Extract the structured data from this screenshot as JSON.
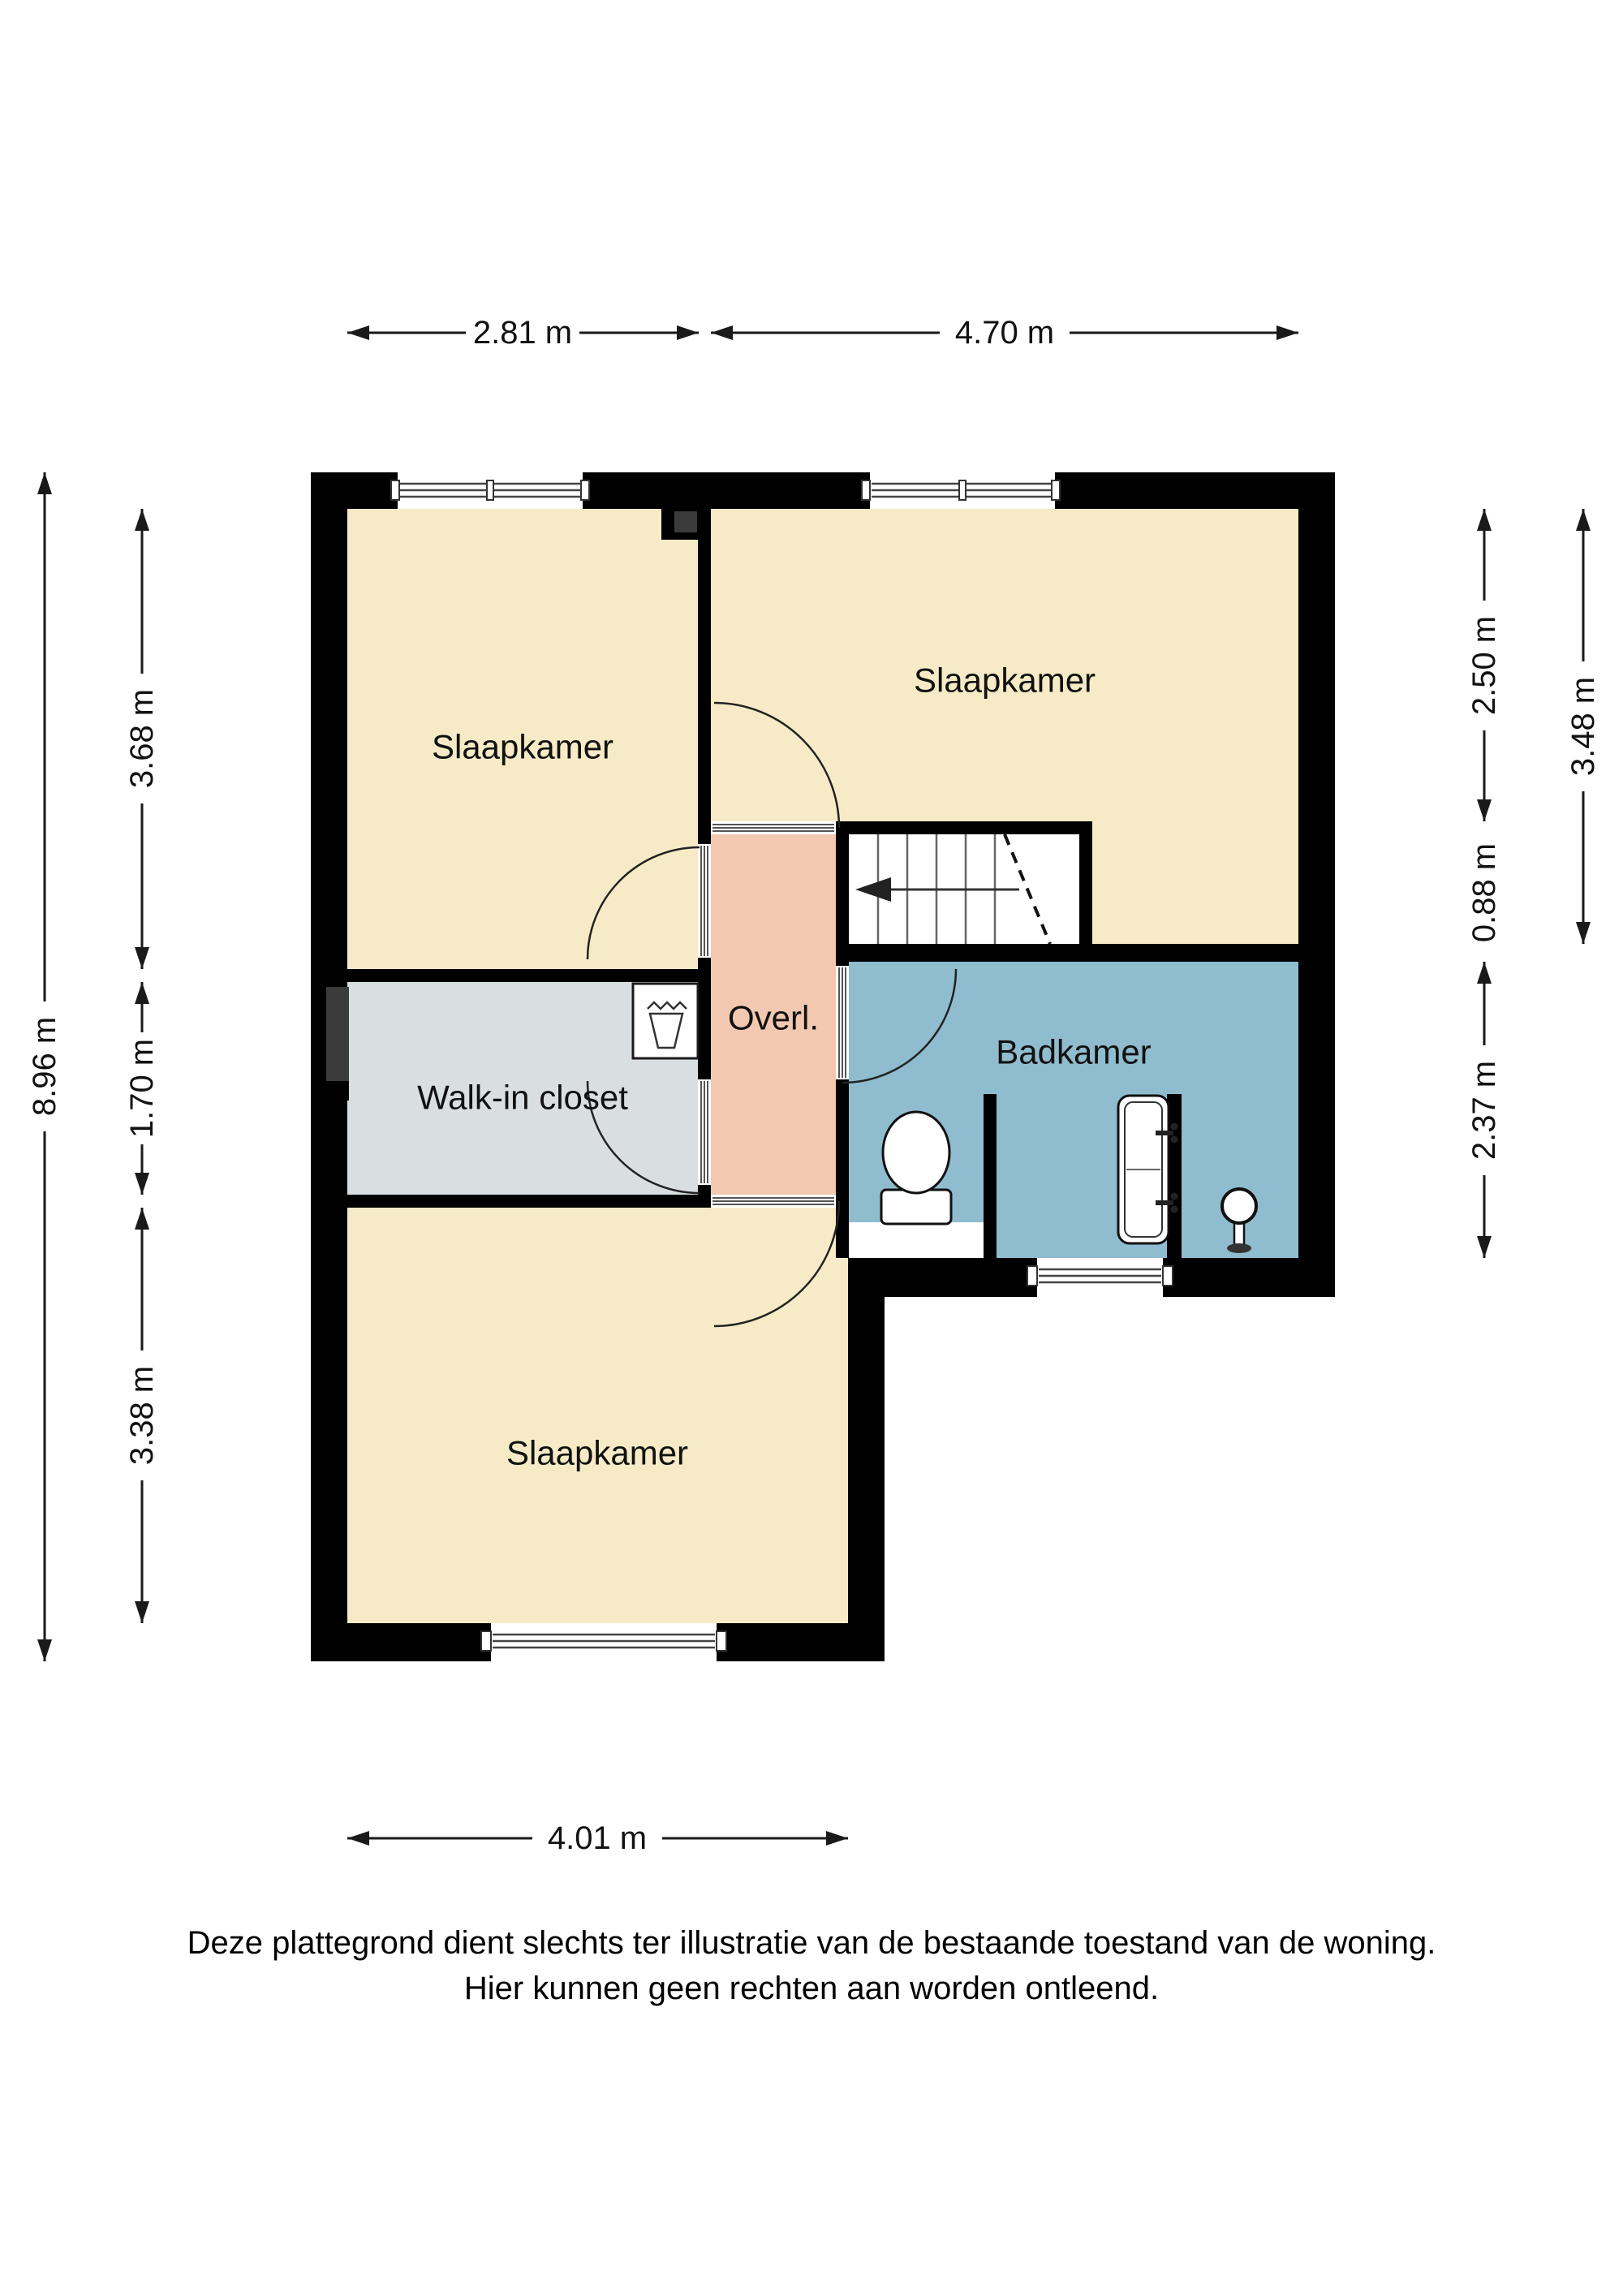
{
  "floorplan": {
    "rooms": {
      "bedroom_top_left": {
        "label": "Slaapkamer"
      },
      "bedroom_top_right": {
        "label": "Slaapkamer"
      },
      "bedroom_bottom": {
        "label": "Slaapkamer"
      },
      "walk_in_closet": {
        "label": "Walk-in closet"
      },
      "landing": {
        "label": "Overl."
      },
      "bathroom": {
        "label": "Badkamer"
      }
    },
    "dimensions": {
      "top_width_left": "2.81 m",
      "top_width_right": "4.70 m",
      "left_total": "8.96 m",
      "left_top": "3.68 m",
      "left_middle": "1.70 m",
      "left_bottom": "3.38 m",
      "right_top": "2.50 m",
      "right_stairs": "0.88 m",
      "right_bathroom": "2.37 m",
      "right_total": "3.48 m",
      "bottom_width": "4.01 m"
    },
    "colors": {
      "wall": "#000000",
      "bedroom": "#F6EBC6",
      "closet": "#D9DFE1",
      "landing": "#F2C8B1",
      "bathroom": "#8FBCCE",
      "duct": "#3B3B3B",
      "stairs": "#FFFFFF"
    },
    "disclaimer": {
      "line1": "Deze plattegrond dient slechts ter illustratie van de bestaande toestand van de woning.",
      "line2": "Hier kunnen geen rechten aan worden ontleend."
    }
  }
}
